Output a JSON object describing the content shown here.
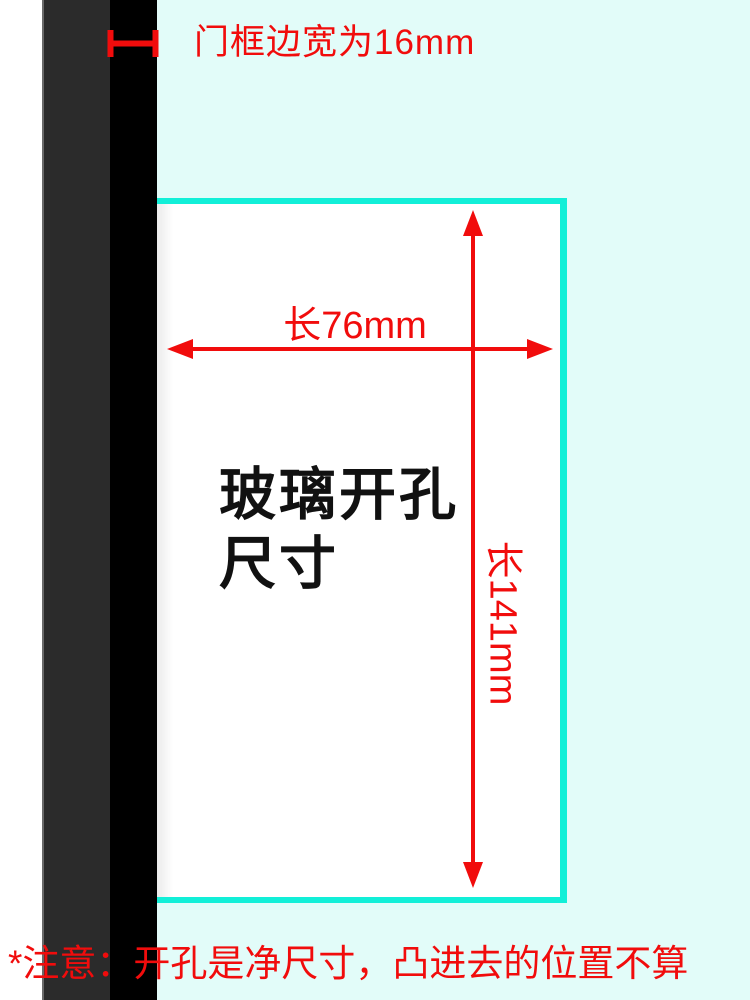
{
  "frame_note": {
    "label": "门框边宽为16mm",
    "frame_edge_width_mm": 16
  },
  "cutout": {
    "title": "玻璃开孔\n尺寸",
    "width_label": "长76mm",
    "height_label": "长141mm",
    "width_mm": 76,
    "height_mm": 141
  },
  "footnote": {
    "text": "*注意：开孔是净尺寸，凸进去的位置不算"
  },
  "colors": {
    "red": "#f10c0c",
    "cyan_border": "#12efd8",
    "background_cyan": "#e2fcf9",
    "frame_gray": "#2b2b2b",
    "frame_black": "#000000"
  }
}
